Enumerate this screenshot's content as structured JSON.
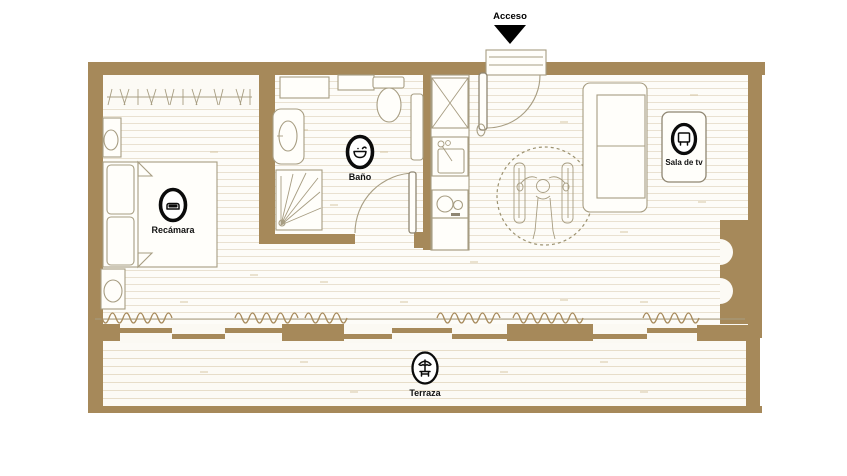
{
  "entrance": {
    "label": "Acceso",
    "icon": "entry-arrow-icon"
  },
  "rooms": {
    "bedroom": {
      "label": "Recámara",
      "icon": "bed-icon"
    },
    "bathroom": {
      "label": "Baño",
      "icon": "washbasin-icon"
    },
    "tv_room": {
      "label": "Sala de tv",
      "icon": "tv-icon"
    },
    "terrace": {
      "label": "Terraza",
      "icon": "parasol-table-icon"
    }
  },
  "features": {
    "wheelchair_turning_circle": "wheelchair-user",
    "furniture": [
      "closet",
      "bed",
      "nightstands",
      "shower",
      "toilet",
      "vanity",
      "kitchen-cabinet",
      "sink",
      "stove",
      "sofa",
      "tv-panel",
      "sliding-glass-doors",
      "curtains"
    ]
  },
  "colors": {
    "wall": "#a6895a",
    "floor_line": "#e9e1d1",
    "terrace_line": "#e7ddc9",
    "outline": "#a79d82",
    "ink": "#111111"
  }
}
